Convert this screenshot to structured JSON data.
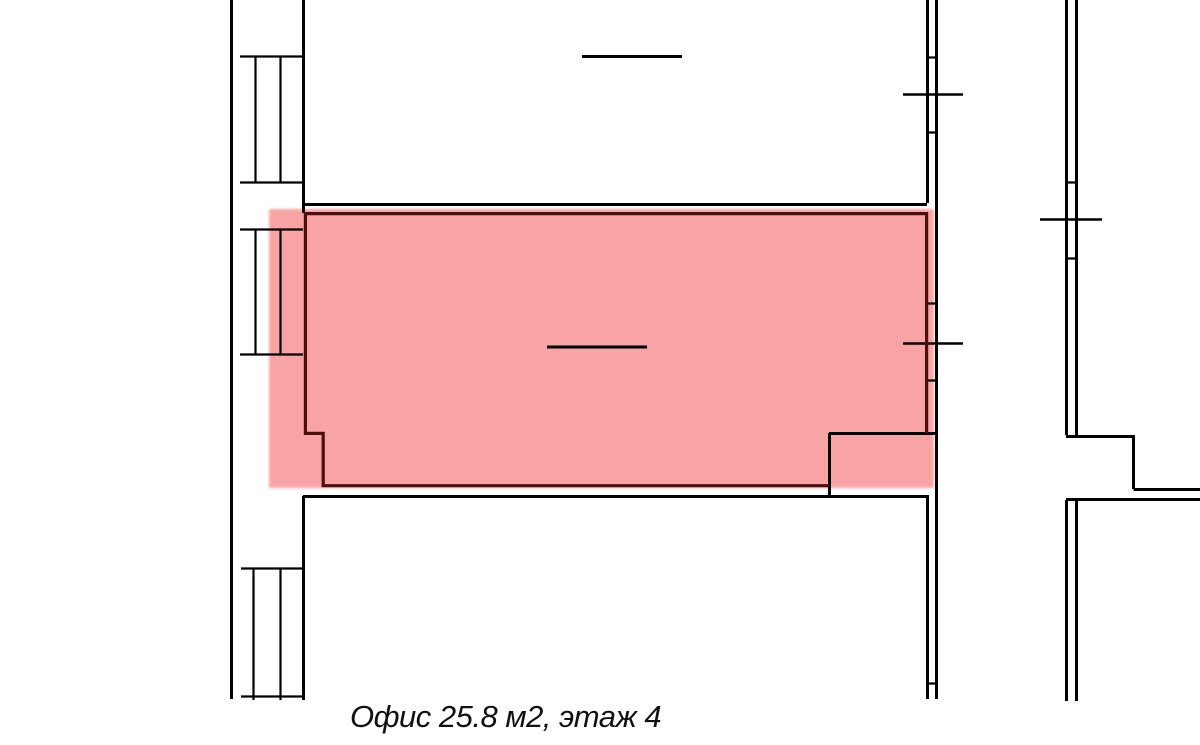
{
  "page": {
    "width": 1200,
    "height": 745,
    "background_color": "#ffffff"
  },
  "caption": {
    "text": "Офис 25.8 м2, этаж 4",
    "room_type": "Офис",
    "area_m2": "25.8",
    "floor": "4"
  },
  "highlight": {
    "fill_color": "#f9a4a4",
    "outline_color": "#4c0f0f"
  },
  "plan": {
    "line_color": "#000000",
    "window_symbols_left_wall": 3,
    "window_marks_right_walls": 3
  }
}
